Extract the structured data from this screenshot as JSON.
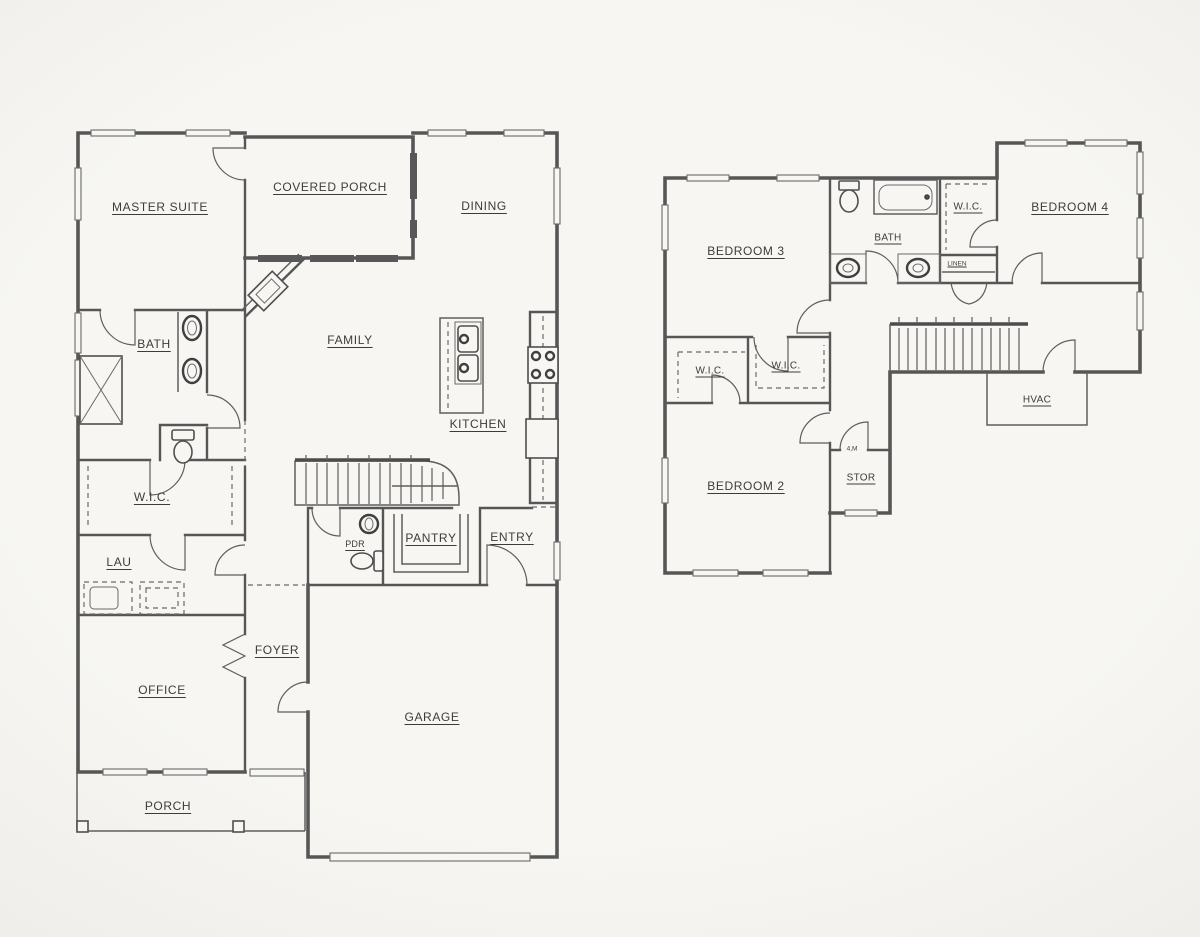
{
  "drawing": {
    "type": "residential floor plan, two floors side by side",
    "colors": {
      "paper": "#f7f6f3",
      "ink": "#565656",
      "label_text": "#3c3c3c"
    }
  },
  "first_floor": {
    "master_suite": "MASTER SUITE",
    "covered_porch": "COVERED PORCH",
    "dining": "DINING",
    "family": "FAMILY",
    "kitchen": "KITCHEN",
    "bath": "BATH",
    "wic": "W.I.C.",
    "laundry": "LAU",
    "office": "OFFICE",
    "porch": "PORCH",
    "foyer": "FOYER",
    "garage": "GARAGE",
    "powder": "PDR",
    "pantry": "PANTRY",
    "entry": "ENTRY"
  },
  "second_floor": {
    "bedroom_3": "BEDROOM 3",
    "bath": "BATH",
    "wic_bedroom4": "W.I.C.",
    "bedroom_4": "BEDROOM 4",
    "linen": "LINEN",
    "wic_left": "W.I.C.",
    "wic_right": "W.I.C.",
    "hvac": "HVAC",
    "bedroom_2": "BEDROOM 2",
    "storage": "STOR",
    "door_note": "4,M"
  }
}
